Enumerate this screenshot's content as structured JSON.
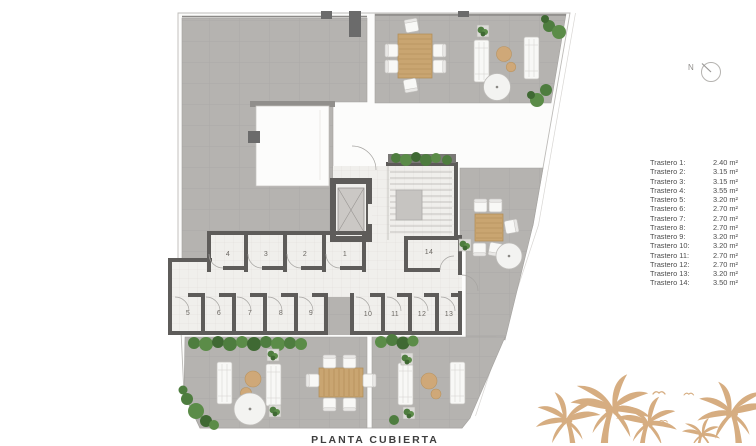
{
  "title": "PLANTA CUBIERTA",
  "north_label": "N",
  "legend": {
    "items": [
      {
        "label": "Trastero 1:",
        "area": "2.40 m²"
      },
      {
        "label": "Trastero 2:",
        "area": "3.15 m²"
      },
      {
        "label": "Trastero 3:",
        "area": "3.15 m²"
      },
      {
        "label": "Trastero 4:",
        "area": "3.55 m²"
      },
      {
        "label": "Trastero 5:",
        "area": "3.20 m²"
      },
      {
        "label": "Trastero 6:",
        "area": "2.70 m²"
      },
      {
        "label": "Trastero 7:",
        "area": "2.70 m²"
      },
      {
        "label": "Trastero 8:",
        "area": "2.70 m²"
      },
      {
        "label": "Trastero 9:",
        "area": "3.20 m²"
      },
      {
        "label": "Trastero 10:",
        "area": "3.20 m²"
      },
      {
        "label": "Trastero 11:",
        "area": "2.70 m²"
      },
      {
        "label": "Trastero 12:",
        "area": "2.70 m²"
      },
      {
        "label": "Trastero 13:",
        "area": "3.20 m²"
      },
      {
        "label": "Trastero 14:",
        "area": "3.50 m²"
      }
    ]
  },
  "plan": {
    "rooms": [
      {
        "number": "1"
      },
      {
        "number": "2"
      },
      {
        "number": "3"
      },
      {
        "number": "4"
      },
      {
        "number": "5"
      },
      {
        "number": "6"
      },
      {
        "number": "7"
      },
      {
        "number": "8"
      },
      {
        "number": "9"
      },
      {
        "number": "10"
      },
      {
        "number": "11"
      },
      {
        "number": "12"
      },
      {
        "number": "13"
      },
      {
        "number": "14"
      }
    ]
  },
  "colors": {
    "terrace": "#b5b3b0",
    "walls": "#5e5c5a",
    "corridor": "#f0efec",
    "wood": "#c9a571",
    "green": "#4e7d3f",
    "palm": "#d4a97b",
    "boundary": "#bdbbb8"
  }
}
